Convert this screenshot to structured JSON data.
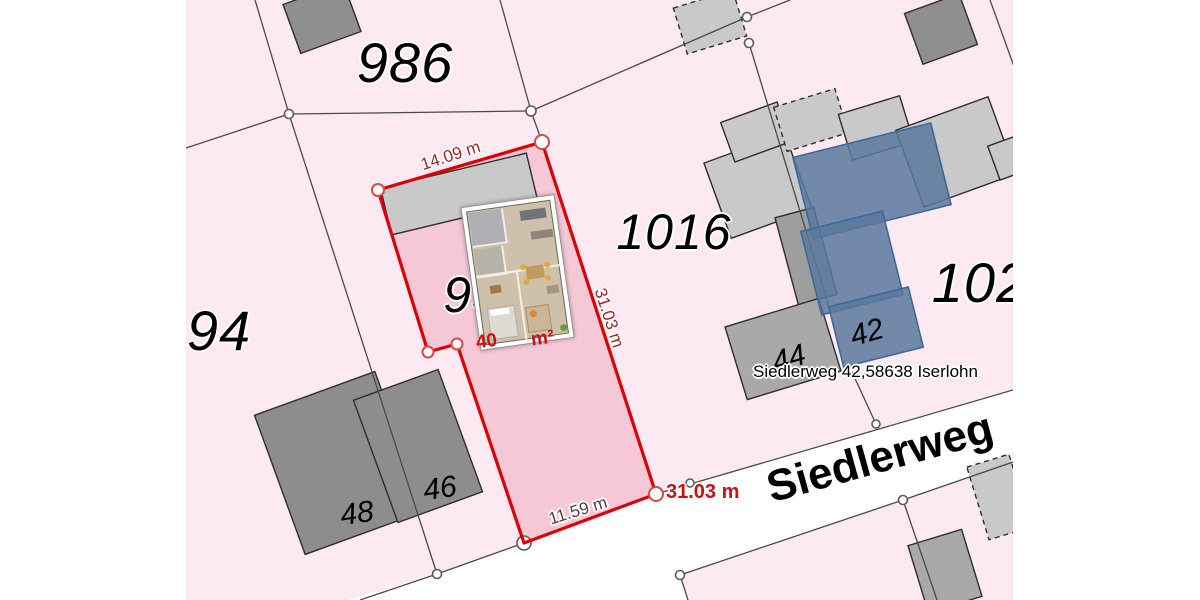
{
  "map": {
    "parcels": [
      {
        "label": "986"
      },
      {
        "label": "1016"
      },
      {
        "label": "94"
      },
      {
        "label": "102"
      },
      {
        "label": "93"
      }
    ],
    "building_numbers": [
      {
        "label": "48"
      },
      {
        "label": "46"
      },
      {
        "label": "44"
      },
      {
        "label": "42"
      }
    ],
    "street": {
      "name": "Siedlerweg"
    },
    "address_callout": {
      "text": "Siedlerweg 42,58638 Iserlohn"
    },
    "measurements": {
      "top_edge": "14.09 m",
      "right_edge": "31.03 m",
      "bottom_edge": "11.59 m",
      "length_callout": "31.03 m"
    },
    "area_label": {
      "prefix": "40",
      "suffix": "m²"
    },
    "colors": {
      "parcel_pink": "#fce9f1",
      "selected_parcel_fill": "#f6c7d5",
      "selected_parcel_border": "#dc0005",
      "street_white": "#ffffff",
      "building_gray_dark": "#8d8d8d",
      "building_gray_light": "#c9c9c9",
      "selected_building_fill": "#5a789c",
      "selected_building_border": "#3e6899",
      "measurement_red": "#9b2828",
      "callout_red": "#cc1016"
    }
  }
}
